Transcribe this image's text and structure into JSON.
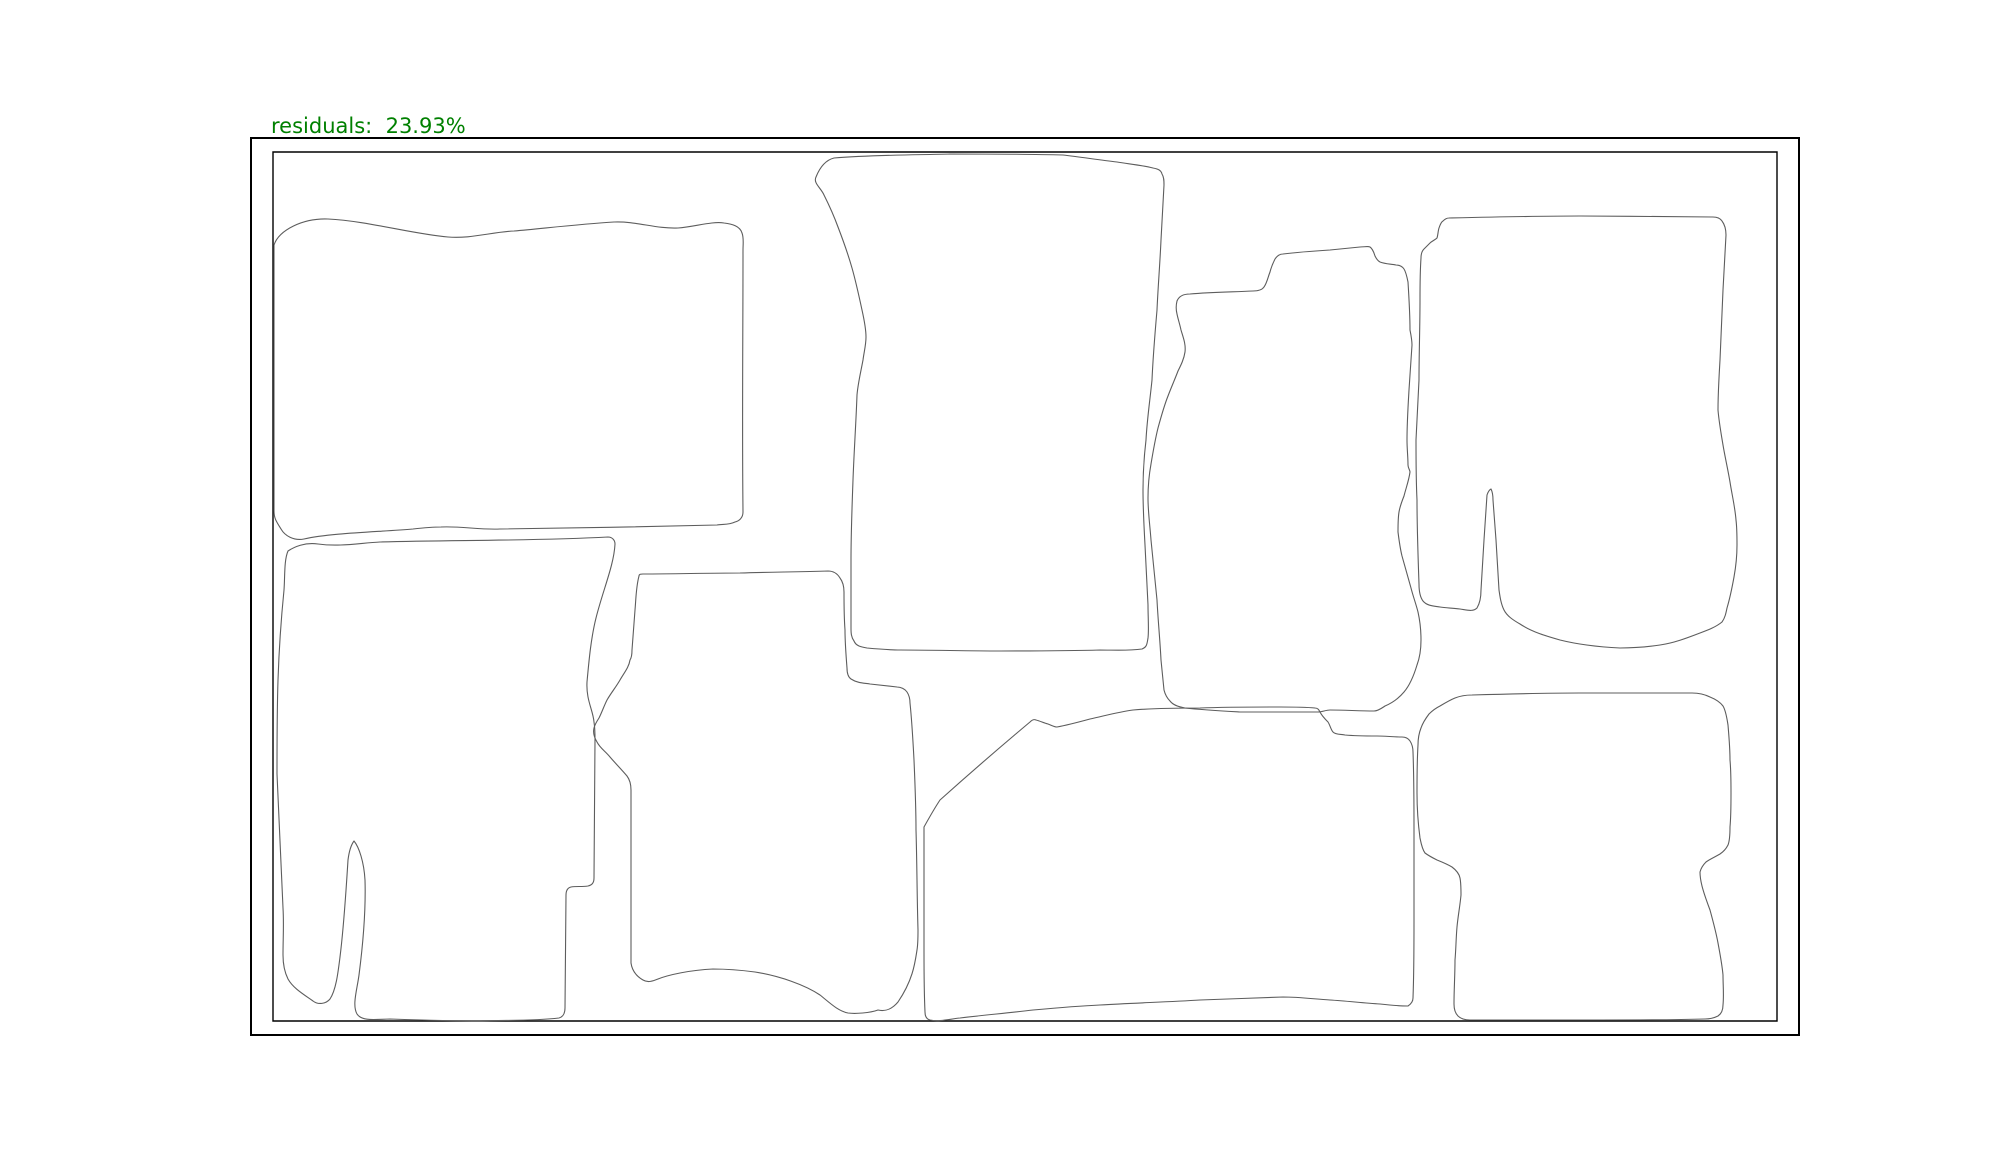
{
  "figure": {
    "title_label": "residuals:  23.93%",
    "residuals_percent": 23.93,
    "label_color": "#008000",
    "outline_color": "#5d5d5d",
    "border_color": "#000000",
    "background_color": "#ffffff"
  },
  "bin": {
    "outer_d": "M 251 138 L 1799 138 L 1799 1035 L 251 1035 Z",
    "inner_d": "M 273 152 L 1777 152 L 1777 1021 L 273 1021 Z"
  },
  "parts": [
    {
      "name": "part-1-top-left-mat",
      "d": "M 274 245 C 279 230 303 218 328 219 C 368 221 412 234 448 237 C 470 239 492 232 514 231 C 547 228 581 224 614 222 C 636 221 656 229 678 228 C 694 227 712 221 724 223 C 732 224 740 226 742 233 C 744 238 743 244 743 250 C 743 337 742 425 743 512 C 743 518 739 521 735 522 C 729 525 723 524 717 525 C 645 527 572 528 500 529 C 480 530 461 526 441 527 C 432 527 422 528 413 529 C 377 532 331 533 304 539 C 294 541 285 536 281 529 C 276 521 274 518 274 511 Z"
    },
    {
      "name": "part-2-bottom-left-mat",
      "d": "M 288 551 C 294 547 305 542 318 544 C 340 547 360 543 380 542 C 456 540 532 541 608 537 C 612 537 615 540 615 544 C 614 565 603 590 596 618 C 591 638 589 660 587 682 C 586 700 593 710 594 722 C 595 728 595 734 595 740 C 595 786 594 832 594 878 C 594 883 592 885 588 886 C 582 887 576 886 571 887 C 567 888 566 891 566 895 C 566 934 565 973 565 1008 C 565 1013 563 1017 559 1018 C 533 1021 506 1020 480 1021 C 450 1021 420 1020 390 1019 C 378 1019 362 1022 357 1014 C 352 1005 357 990 359 975 C 363 944 366 912 365 880 C 364 862 359 847 354 841 C 351 845 349 852 348 860 C 346 892 344 925 340 957 C 338 973 336 990 330 999 C 326 1004 318 1005 313 1001 C 303 994 293 988 288 979 C 284 971 283 963 283 955 C 283 939 284 924 283 908 C 282 886 281 863 280 841 C 279 819 278 796 277 774 C 277 743 277 711 278 680 C 279 650 281 620 284 590 C 285 577 284 560 288 551 Z"
    },
    {
      "name": "part-3-tall-center-mat",
      "d": "M 816 177 C 820 167 826 160 834 158 C 872 155 911 155 950 154 C 988 154 1026 154 1063 155 C 1081 157 1099 160 1117 162 C 1129 164 1141 165 1153 168 C 1158 169 1161 170 1162 174 C 1164 177 1164 181 1164 185 C 1163 203 1162 222 1161 240 C 1160 263 1158 287 1157 310 C 1155 333 1153 357 1152 380 C 1150 400 1147 420 1146 440 C 1144 457 1143 473 1143 490 C 1143 508 1144 527 1145 545 C 1146 565 1147 585 1148 605 C 1148 617 1149 630 1148 638 C 1147 644 1147 647 1142 649 C 1128 651 1114 650 1100 650 C 1067 651 1033 651 1000 651 C 967 651 933 650 900 650 C 889 650 878 649 867 648 C 861 647 856 646 854 641 C 851 637 851 632 851 628 C 851 605 851 583 851 560 C 851 533 852 507 853 480 C 854 452 856 423 857 395 C 858 383 861 371 863 360 C 864 352 866 345 866 337 C 866 328 864 319 862 310 C 859 296 856 282 852 268 C 848 254 843 240 838 227 C 834 216 829 205 824 195 C 821 188 813 183 816 177 Z"
    },
    {
      "name": "part-4-center-bottom-mat",
      "d": "M 639 576 C 639 574 641 574 643 574 C 675 574 707 573 740 573 C 769 572 799 572 828 571 C 833 571 837 573 840 578 C 843 582 844 587 844 592 C 844 605 844 617 845 630 C 845 643 846 655 847 668 C 847 673 848 677 851 679 C 857 683 864 683 870 684 C 879 685 888 686 897 687 C 901 687 905 689 907 692 C 909 695 910 699 910 703 C 912 722 913 741 914 760 C 915 783 916 807 916 830 C 917 863 917 897 918 930 C 918 937 918 944 917 950 C 915 963 913 980 898 1002 C 893 1008 886 1012 878 1010 C 870 1013 855 1014 848 1013 C 838 1011 830 1003 820 995 C 805 985 780 976 755 972 C 740 970 725 969 713 969 C 690 970 668 975 658 979 C 653 981 648 983 643 980 C 636 976 632 970 631 963 C 631 905 631 848 631 790 C 631 785 630 780 627 776 C 622 770 616 764 610 757 C 605 751 600 748 597 742 C 594 737 593 732 594 728 C 595 724 597 721 599 718 C 602 712 604 706 607 700 C 611 693 616 687 620 680 C 624 673 629 667 630 660 C 632 657 632 653 632 650 C 633 637 634 623 635 610 C 636 599 636 587 639 576 Z"
    },
    {
      "name": "part-5-middle-right-mat",
      "d": "M 1177 301 C 1179 296 1184 294 1190 294 C 1211 292 1232 292 1253 291 C 1258 291 1262 290 1264 287 C 1267 283 1268 277 1270 272 C 1271 268 1273 263 1275 259 C 1277 256 1280 254 1283 254 C 1299 252 1314 251 1330 250 C 1340 249 1350 248 1360 247 C 1364 247 1368 246 1370 247 C 1373 249 1374 253 1375 256 C 1376 258 1378 261 1380 262 C 1385 264 1391 264 1396 265 C 1399 265 1402 266 1404 269 C 1406 272 1407 277 1408 282 C 1409 298 1410 314 1410 330 C 1411 335 1412 340 1412 345 C 1411 360 1410 375 1409 390 C 1408 407 1407 423 1407 440 C 1407 449 1408 457 1408 465 C 1408 468 1410 470 1410 472 C 1409 480 1406 488 1404 496 C 1402 501 1400 506 1399 512 C 1398 518 1398 525 1398 532 C 1399 540 1400 548 1402 556 C 1405 567 1408 577 1411 588 C 1413 596 1416 604 1418 612 C 1420 621 1421 630 1421 640 C 1421 648 1420 657 1417 665 C 1414 675 1410 685 1404 692 C 1399 698 1392 703 1385 706 C 1382 708 1378 711 1374 711 C 1359 711 1345 710 1330 710 C 1326 710 1322 712 1318 712 C 1292 712 1266 712 1240 712 C 1222 711 1203 710 1185 708 C 1179 707 1173 705 1170 701 C 1167 698 1165 694 1164 690 C 1163 680 1162 670 1161 660 C 1160 640 1158 620 1157 600 C 1155 580 1153 560 1151 540 C 1150 526 1148 512 1148 498 C 1148 487 1149 475 1151 464 C 1153 452 1155 440 1158 428 C 1161 417 1164 406 1168 396 C 1171 388 1175 379 1178 371 C 1181 365 1184 359 1185 352 C 1186 344 1183 337 1181 330 C 1180 325 1178 319 1177 314 C 1176 310 1176 305 1177 301 Z"
    },
    {
      "name": "part-6-top-right-mat",
      "d": "M 1449 218 C 1493 217 1536 216 1580 216 C 1624 216 1671 217 1713 217 C 1717 217 1720 218 1722 221 C 1725 225 1726 230 1726 235 C 1725 253 1724 272 1723 290 C 1722 313 1721 337 1720 360 C 1719 377 1718 393 1718 410 C 1719 422 1721 433 1723 445 C 1725 457 1728 470 1730 482 C 1732 495 1735 507 1736 520 C 1737 528 1737 537 1737 545 C 1737 556 1736 566 1734 577 C 1732 588 1730 598 1727 608 C 1726 613 1725 618 1722 622 C 1716 627 1708 630 1700 633 C 1687 638 1674 643 1660 645 C 1647 647 1633 648 1620 648 C 1600 647 1580 645 1560 640 C 1546 636 1532 632 1520 624 C 1513 620 1507 616 1504 610 C 1501 604 1500 597 1499 590 C 1498 573 1497 557 1496 540 C 1495 527 1494 513 1493 500 C 1493 496 1492 491 1491 489 C 1489 490 1488 492 1487 495 C 1486 510 1485 525 1484 540 C 1483 557 1482 573 1481 590 C 1481 596 1480 603 1477 608 C 1473 612 1467 610 1460 609 C 1453 608 1446 608 1440 607 C 1434 606 1427 606 1423 601 C 1420 597 1419 590 1419 584 C 1418 556 1417 528 1417 500 C 1416 480 1416 460 1416 440 C 1417 420 1418 400 1419 380 C 1419 353 1420 327 1420 300 C 1420 286 1420 272 1421 258 C 1421 254 1422 251 1424 249 C 1426 247 1428 245 1430 243 C 1432 241 1435 240 1437 238 C 1438 235 1438 231 1439 228 C 1440 225 1441 222 1443 221 C 1445 219 1447 218 1449 218 Z"
    },
    {
      "name": "part-7-bottom-center-mat",
      "d": "M 924 827 C 929 818 934 809 940 800 C 969 774 999 748 1030 722 C 1032 720 1034 719 1036 720 C 1040 721 1044 723 1048 724 C 1051 725 1054 727 1057 727 C 1068 725 1079 722 1090 719 C 1104 716 1118 712 1133 710 C 1155 708 1178 708 1200 708 C 1227 707 1253 707 1280 707 C 1292 707 1304 707 1315 708 C 1318 708 1319 710 1320 712 C 1322 716 1325 719 1328 722 C 1330 725 1331 730 1333 732 C 1336 735 1341 734 1345 735 C 1356 736 1366 736 1377 736 C 1385 736 1394 737 1402 737 C 1405 737 1408 738 1410 741 C 1412 744 1413 748 1413 752 C 1414 778 1414 804 1414 830 C 1414 860 1414 890 1414 920 C 1414 946 1414 972 1413 998 C 1413 1001 1411 1004 1408 1006 C 1399 1006 1389 1005 1380 1004 C 1363 1003 1347 1001 1330 1000 C 1314 999 1299 997 1283 997 C 1255 998 1228 999 1200 1000 C 1167 1002 1133 1003 1100 1005 C 1078 1006 1055 1008 1033 1010 C 1009 1013 984 1015 960 1018 C 950 1019 939 1022 930 1020 C 926 1019 925 1016 925 1012 C 924 991 924 971 924 950 C 924 923 924 897 924 870 C 924 856 924 841 924 827 Z"
    },
    {
      "name": "part-8-bottom-right-mat",
      "d": "M 1472 695 C 1508 694 1544 693 1580 693 C 1617 693 1655 693 1692 693 C 1698 693 1704 694 1710 697 C 1715 699 1720 702 1723 706 C 1726 711 1727 719 1728 725 C 1729 737 1730 748 1730 760 C 1731 771 1731 782 1731 793 C 1731 804 1731 816 1730 827 C 1730 833 1730 840 1728 845 C 1726 849 1723 852 1720 854 C 1715 857 1710 859 1706 862 C 1703 865 1701 868 1700 872 C 1700 877 1701 882 1702 886 C 1704 894 1707 902 1710 910 C 1713 921 1716 932 1718 943 C 1720 954 1722 964 1723 975 C 1723 985 1724 995 1723 1005 C 1723 1010 1721 1014 1718 1016 C 1714 1018 1709 1019 1705 1019 C 1670 1020 1635 1020 1600 1020 C 1557 1020 1513 1020 1470 1020 C 1465 1020 1461 1019 1458 1016 C 1455 1013 1454 1008 1454 1004 C 1454 989 1455 975 1455 960 C 1456 949 1456 938 1457 927 C 1458 916 1460 906 1461 895 C 1461 889 1461 883 1460 878 C 1459 873 1456 870 1452 867 C 1447 864 1442 862 1437 860 C 1433 858 1429 856 1425 853 C 1422 849 1421 843 1420 838 C 1418 823 1417 808 1417 793 C 1417 777 1417 761 1418 745 C 1418 739 1419 733 1421 728 C 1423 722 1426 718 1429 714 C 1432 711 1436 708 1440 706 C 1445 703 1450 700 1455 698 C 1460 696 1466 695 1472 695 Z"
    }
  ]
}
